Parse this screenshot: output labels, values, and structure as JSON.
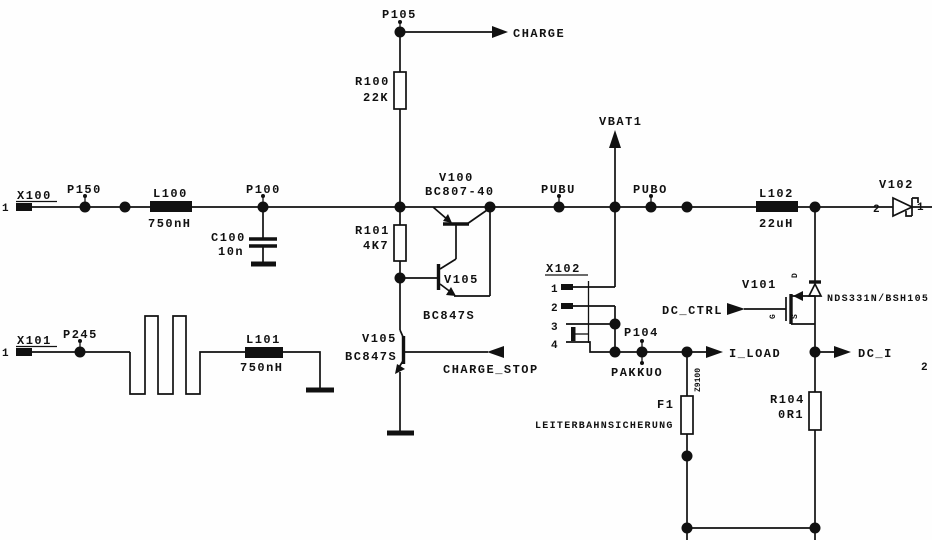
{
  "diagram": {
    "type": "circuit-schematic",
    "background": "#fefefe",
    "line_color": "#111111"
  },
  "connectors": {
    "x100": {
      "ref": "X100",
      "pin1": "1"
    },
    "x101": {
      "ref": "X101",
      "pin1": "1"
    },
    "x102": {
      "ref": "X102",
      "pins": [
        "1",
        "2",
        "3",
        "4"
      ]
    },
    "edge_pin_right": "2"
  },
  "testpoints": {
    "p150": "P150",
    "p100": "P100",
    "p105": "P105",
    "p245": "P245",
    "p104": "P104",
    "pubu": "PUBU",
    "pubo": "PUBO"
  },
  "inductors": {
    "l100": {
      "ref": "L100",
      "value": "750nH"
    },
    "l101": {
      "ref": "L101",
      "value": "750nH"
    },
    "l102": {
      "ref": "L102",
      "value": "22uH"
    }
  },
  "capacitors": {
    "c100": {
      "ref": "C100",
      "value": "10n"
    }
  },
  "resistors": {
    "r100": {
      "ref": "R100",
      "value": "22K"
    },
    "r101": {
      "ref": "R101",
      "value": "4K7"
    },
    "r104": {
      "ref": "R104",
      "value": "0R1"
    }
  },
  "transistors": {
    "v100": {
      "ref": "V100",
      "part": "BC807-40"
    },
    "v105a": {
      "ref": "V105",
      "part": "BC847S"
    },
    "v105b": {
      "ref": "V105",
      "part": "BC847S"
    },
    "v101": {
      "ref": "V101",
      "part": "NDS331N/BSH105",
      "drain": "D",
      "gate": "G",
      "source": "S"
    }
  },
  "diodes": {
    "v102": {
      "ref": "V102",
      "pin_anode": "2",
      "pin_cathode": "1"
    }
  },
  "fuse": {
    "f1": {
      "ref": "F1",
      "note": "LEITERBAHNSICHERUNG",
      "marking": "Z9100"
    }
  },
  "nets": {
    "charge": "CHARGE",
    "charge_stop": "CHARGE_STOP",
    "vbat1": "VBAT1",
    "pakkuo": "PAKKUO",
    "dc_ctrl": "DC_CTRL",
    "i_load": "I_LOAD",
    "dc_i": "DC_I"
  }
}
